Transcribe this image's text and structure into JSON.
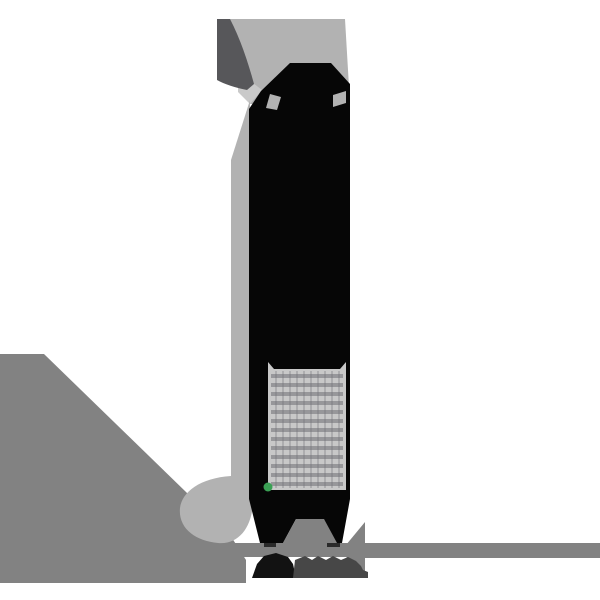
{
  "scene": {
    "kind": "posterized-illustration",
    "subject": "tall black clothespin-like object with gray light ribbons, fine-print label block, green dot, ground shadow",
    "label_block": {
      "legible": false,
      "style": "dense illegible fine-print grid rows"
    },
    "colors": {
      "background": "#ffffff",
      "ribbon_light": "#b2b2b2",
      "ribbon_lighter": "#c9c9c9",
      "fin_dark": "#57575a",
      "ground_mid": "#828282",
      "object_black": "#060606",
      "label_bg": "#c8c8c8",
      "label_ink": "#707076",
      "green_dot": "#3aa054",
      "shadow_dark": "#121212",
      "shadow_gray": "#474747",
      "foot_contact": "#2a2a2a"
    }
  }
}
